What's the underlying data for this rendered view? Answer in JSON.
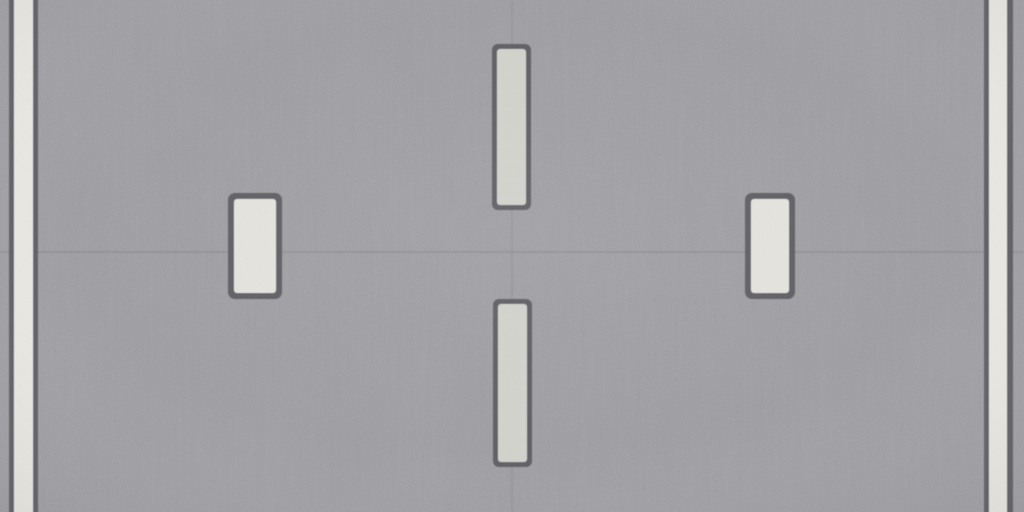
{
  "scene": {
    "surface": {
      "base_color": "#a8a8ac",
      "grain_dark": "#6e6e74",
      "grain_light": "#dcdce0",
      "streak_color": "#73737a",
      "streak_light": "#c6c6ca",
      "blotch_color": "#8b8a8e",
      "vignette_color": "#55555b"
    },
    "seams": {
      "horizontal": {
        "x": 0,
        "y": 251,
        "length": 1024,
        "thickness": 2,
        "color": "#6d6d73"
      },
      "vertical": {
        "x": 511,
        "y": 0,
        "length": 512,
        "thickness": 2,
        "color": "#74747a"
      }
    },
    "markings": [
      {
        "name": "edge-line-left",
        "outline": "#5c5c61",
        "fill": "#efede7",
        "outer": [
          9,
          -8,
          29,
          528
        ],
        "inner": [
          14,
          -8,
          19,
          528
        ],
        "outer_rx": 0,
        "inner_rx": 0
      },
      {
        "name": "edge-line-right",
        "outline": "#5c5c61",
        "fill": "#efede7",
        "outer": [
          984,
          -8,
          29,
          528
        ],
        "inner": [
          989,
          -8,
          18,
          528
        ],
        "outer_rx": 0,
        "inner_rx": 0
      },
      {
        "name": "lane-dash-left",
        "outline": "#5c5c61",
        "fill": "#eae9e3",
        "outer": [
          228,
          193,
          54,
          106
        ],
        "inner": [
          234,
          199,
          42,
          94
        ],
        "outer_rx": 7,
        "inner_rx": 3
      },
      {
        "name": "lane-dash-right",
        "outline": "#5c5c61",
        "fill": "#eae9e3",
        "outer": [
          745,
          193,
          50,
          106
        ],
        "inner": [
          751,
          199,
          38,
          94
        ],
        "outer_rx": 7,
        "inner_rx": 3
      },
      {
        "name": "center-dash-top",
        "outline": "#5c5c61",
        "fill": "#d7d8d1",
        "outer": [
          492,
          44,
          39,
          166
        ],
        "inner": [
          497,
          49,
          29,
          156
        ],
        "outer_rx": 6,
        "inner_rx": 3
      },
      {
        "name": "center-dash-bottom",
        "outline": "#5c5c61",
        "fill": "#d7d8d1",
        "outer": [
          493,
          299,
          39,
          168
        ],
        "inner": [
          498,
          304,
          29,
          158
        ],
        "outer_rx": 6,
        "inner_rx": 3
      }
    ]
  }
}
